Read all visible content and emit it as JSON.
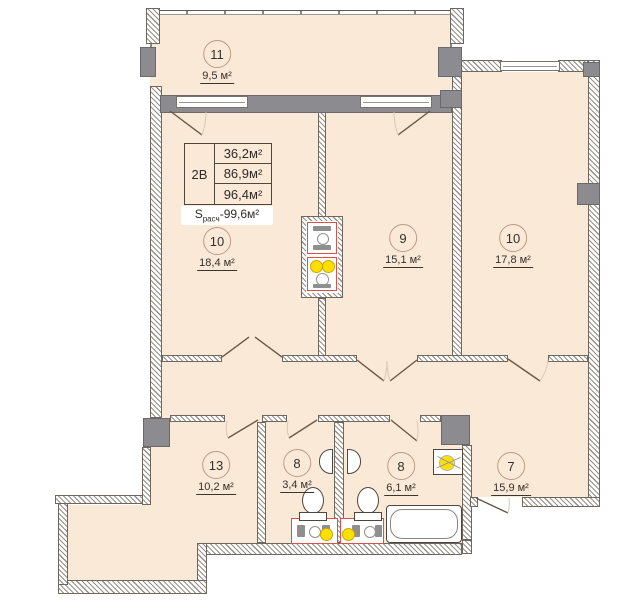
{
  "plan_title": "apartment-floor-plan",
  "legend": {
    "type_label": "2В",
    "rows": [
      "36,2м²",
      "86,9м²",
      "96,4м²"
    ],
    "total_prefix": "S",
    "total_sub": "расч",
    "total_sep": "-",
    "total_value": "99,6м²"
  },
  "rooms": [
    {
      "id": "balcony",
      "number": "11",
      "area": "9,5 м²"
    },
    {
      "id": "room-10-left",
      "number": "10",
      "area": "18,4 м²"
    },
    {
      "id": "room-9",
      "number": "9",
      "area": "15,1 м²"
    },
    {
      "id": "room-10-right",
      "number": "10",
      "area": "17,8 м²"
    },
    {
      "id": "room-13",
      "number": "13",
      "area": "10,2 м²"
    },
    {
      "id": "room-8-small",
      "number": "8",
      "area": "3,4 м²"
    },
    {
      "id": "room-8-large",
      "number": "8",
      "area": "6,1 м²"
    },
    {
      "id": "room-7",
      "number": "7",
      "area": "15,9 м²"
    }
  ],
  "colors": {
    "floor": "#fbe9d8",
    "wall_gray": "#8c8c90",
    "shaft_red": "#d8514d",
    "riser_yellow": "#ffdf00"
  }
}
